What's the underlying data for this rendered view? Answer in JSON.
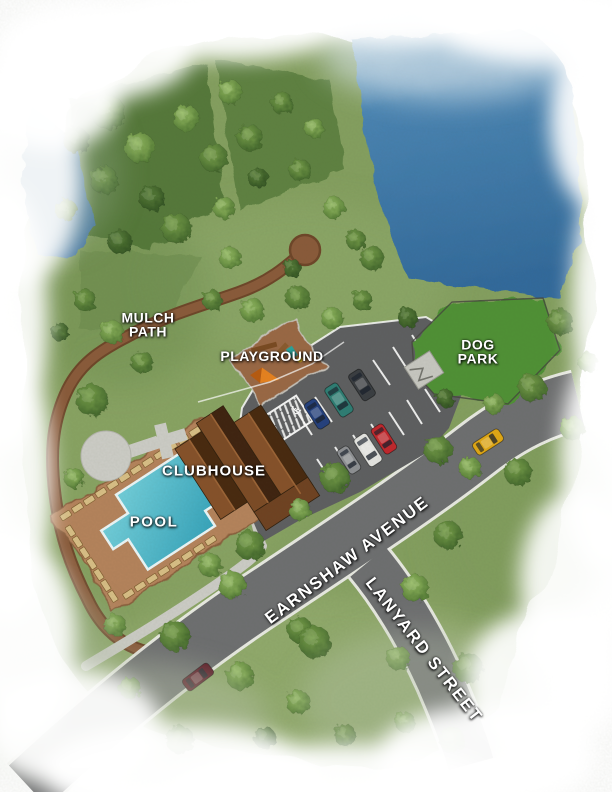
{
  "map": {
    "type": "community-site-plan-illustration",
    "labels": {
      "mulch_path": {
        "line1": "MULCH",
        "line2": "PATH"
      },
      "playground": "PLAYGROUND",
      "dog_park": {
        "line1": "DOG",
        "line2": "PARK"
      },
      "clubhouse": "CLUBHOUSE",
      "pool": "POOL",
      "earnshaw_avenue": "EARNSHAW AVENUE",
      "lanyard_street": "LANYARD STREET"
    },
    "colors": {
      "grass": "#85a061",
      "forest_patch": "#52773a",
      "pond_water": "#3f7aad",
      "pool_water": "#4fbccb",
      "road": "#6e6f71",
      "parking_asphalt": "#5e5f61",
      "sidewalk": "#cdcdc7",
      "mulch": "#8a5a3a",
      "playground_mulch": "#9a6844",
      "pool_deck": "#b5835c",
      "clubhouse_roof_dark": "#48290f",
      "clubhouse_roof_light": "#86512a",
      "dog_park_green": "#4f9136",
      "label_text": "#ffffff"
    },
    "features": [
      "pond",
      "woods",
      "mulch path with cul-de-sac",
      "playground",
      "parking lot with handicap stalls",
      "dog park with gated entry",
      "clubhouse",
      "pool with lounge chairs",
      "Earnshaw Avenue",
      "Lanyard Street"
    ],
    "vehicles": [
      {
        "name": "blue-sedan-parked",
        "color": "#24407e",
        "x": 317,
        "y": 414,
        "rot": 57,
        "len": 30,
        "wid": 14
      },
      {
        "name": "teal-van-parked",
        "color": "#2e7d74",
        "x": 339,
        "y": 400,
        "rot": 57,
        "len": 34,
        "wid": 15
      },
      {
        "name": "gray-suv-parked",
        "color": "#3a3d42",
        "x": 362,
        "y": 385,
        "rot": 57,
        "len": 31,
        "wid": 15
      },
      {
        "name": "silver-car-parked",
        "color": "#8e9094",
        "x": 349,
        "y": 460,
        "rot": 57,
        "len": 28,
        "wid": 13
      },
      {
        "name": "white-van-parked",
        "color": "#e6e6e3",
        "x": 368,
        "y": 450,
        "rot": 57,
        "len": 33,
        "wid": 15
      },
      {
        "name": "red-car-parked",
        "color": "#c1272d",
        "x": 384,
        "y": 439,
        "rot": 57,
        "len": 30,
        "wid": 14
      },
      {
        "name": "yellow-car-on-road",
        "color": "#e2a815",
        "x": 488,
        "y": 442,
        "rot": -33,
        "len": 31,
        "wid": 14
      },
      {
        "name": "maroon-car-on-road",
        "color": "#5a1423",
        "x": 198,
        "y": 677,
        "rot": -37,
        "len": 32,
        "wid": 14
      }
    ],
    "trees": [
      [
        108,
        112,
        17,
        1
      ],
      [
        76,
        140,
        13,
        0
      ],
      [
        140,
        148,
        15,
        2
      ],
      [
        104,
        180,
        14,
        1
      ],
      [
        152,
        198,
        13,
        0
      ],
      [
        66,
        210,
        11,
        1
      ],
      [
        186,
        118,
        13,
        2
      ],
      [
        214,
        158,
        14,
        1
      ],
      [
        176,
        228,
        15,
        1
      ],
      [
        120,
        242,
        12,
        0
      ],
      [
        224,
        208,
        11,
        2
      ],
      [
        250,
        138,
        13,
        1
      ],
      [
        230,
        92,
        12,
        2
      ],
      [
        282,
        103,
        11,
        1
      ],
      [
        314,
        128,
        10,
        2
      ],
      [
        258,
        178,
        10,
        0
      ],
      [
        300,
        170,
        11,
        1
      ],
      [
        334,
        208,
        11,
        2
      ],
      [
        356,
        240,
        10,
        1
      ],
      [
        372,
        258,
        12,
        1
      ],
      [
        230,
        258,
        11,
        2
      ],
      [
        212,
        300,
        10,
        1
      ],
      [
        252,
        310,
        12,
        2
      ],
      [
        298,
        298,
        12,
        1
      ],
      [
        332,
        318,
        11,
        2
      ],
      [
        362,
        300,
        10,
        1
      ],
      [
        292,
        268,
        9,
        0
      ],
      [
        408,
        318,
        10,
        0
      ],
      [
        85,
        300,
        11,
        1
      ],
      [
        60,
        332,
        9,
        0
      ],
      [
        112,
        332,
        12,
        2
      ],
      [
        142,
        362,
        11,
        1
      ],
      [
        92,
        400,
        16,
        1
      ],
      [
        74,
        478,
        10,
        2
      ],
      [
        560,
        322,
        13,
        1
      ],
      [
        588,
        362,
        10,
        2
      ],
      [
        532,
        388,
        14,
        1
      ],
      [
        572,
        428,
        12,
        2
      ],
      [
        518,
        472,
        14,
        1
      ],
      [
        438,
        450,
        14,
        1
      ],
      [
        470,
        468,
        11,
        2
      ],
      [
        445,
        398,
        9,
        0
      ],
      [
        494,
        404,
        10,
        2
      ],
      [
        335,
        478,
        15,
        1
      ],
      [
        300,
        510,
        11,
        2
      ],
      [
        250,
        545,
        15,
        1
      ],
      [
        232,
        585,
        14,
        2
      ],
      [
        300,
        630,
        13,
        1
      ],
      [
        210,
        565,
        12,
        2
      ],
      [
        115,
        625,
        11,
        2
      ],
      [
        315,
        642,
        16,
        1
      ],
      [
        415,
        588,
        14,
        2
      ],
      [
        448,
        535,
        14,
        1
      ],
      [
        468,
        668,
        15,
        1
      ],
      [
        398,
        658,
        12,
        2
      ],
      [
        452,
        740,
        13,
        1
      ],
      [
        405,
        722,
        10,
        2
      ],
      [
        175,
        636,
        15,
        1
      ],
      [
        240,
        676,
        14,
        2
      ],
      [
        180,
        740,
        14,
        1
      ],
      [
        298,
        702,
        12,
        2
      ],
      [
        345,
        735,
        11,
        1
      ],
      [
        265,
        738,
        11,
        0
      ],
      [
        130,
        688,
        11,
        1
      ]
    ]
  }
}
